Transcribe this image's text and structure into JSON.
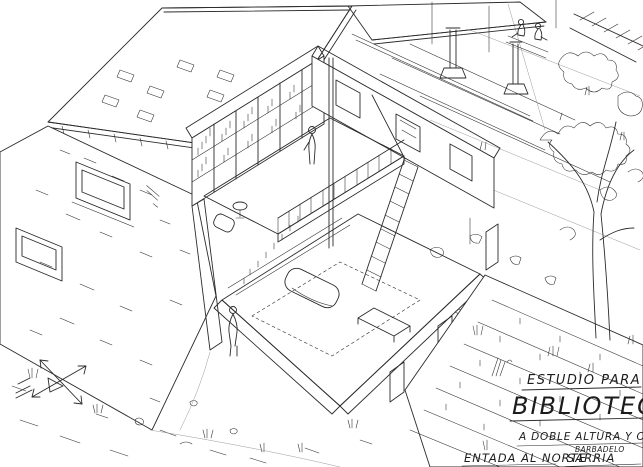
{
  "drawing": {
    "colors": {
      "ink": "#2b2b2b",
      "paper": "#ffffff"
    },
    "title_block": {
      "kicker": "ESTUDIO PARA",
      "title": "BIBLIOTECA",
      "subtitle": "A DOBLE ALTURA Y ORI-",
      "note_small": "BARBADELO",
      "footer": "ENTADA AL NORTE .",
      "footer_place": "SARRIA"
    },
    "compass": {
      "icon": "crossed-orientation-arrows"
    }
  }
}
